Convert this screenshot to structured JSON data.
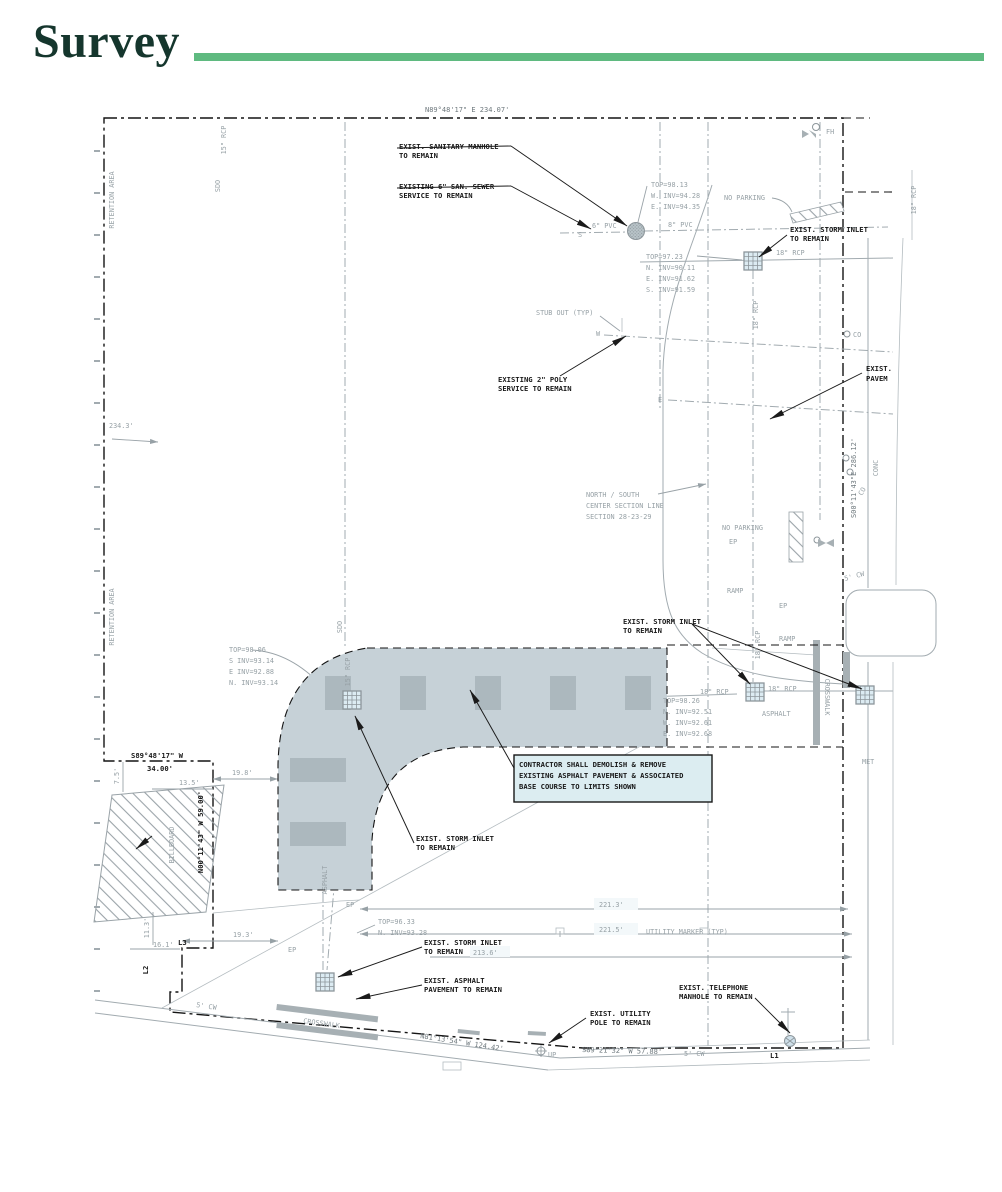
{
  "header": {
    "title": "Survey"
  },
  "colors": {
    "parcel": "#d2e5ef",
    "hatch_base": "#c6d1d7",
    "line_gray": "#9aa3a8",
    "black": "#181818",
    "title_green": "#15362d",
    "rule_green": "#5fba80"
  },
  "boundary": {
    "north": "N89°48'17\" E 234.07'",
    "east": "S00°11'43\"E 286.12'",
    "south_a": "N81°13'54\" W 124.42'",
    "south_b": "S89°21'32\" W 57.88'",
    "notch_bearing": "S89°48'17\" W",
    "notch_length": "34.00'",
    "notch_side": "N00°11'43\" W 59.00'",
    "l1": "L1",
    "l2": "L2",
    "l3": "L3"
  },
  "callouts": {
    "sanitary": {
      "l1": "EXIST. SANITARY MANHOLE",
      "l2": "TO REMAIN"
    },
    "sewer": {
      "l1": "EXISTING 6\" SAN. SEWER",
      "l2": "SERVICE TO REMAIN"
    },
    "storm_ne": {
      "l1": "EXIST. STORM INLET",
      "l2": "TO REMAIN"
    },
    "poly": {
      "l1": "EXISTING 2\" POLY",
      "l2": "SERVICE TO REMAIN"
    },
    "pave_e": {
      "l1": "EXIST.",
      "l2": "PAVEM"
    },
    "storm_mid": {
      "l1": "EXIST. STORM INLET",
      "l2": "TO REMAIN"
    },
    "storm_c": {
      "l1": "EXIST. STORM INLET",
      "l2": "TO REMAIN"
    },
    "storm_s": {
      "l1": "EXIST. STORM INLET",
      "l2": "TO REMAIN"
    },
    "asphalt": {
      "l1": "EXIST. ASPHALT",
      "l2": "PAVEMENT TO REMAIN"
    },
    "phone": {
      "l1": "EXIST. TELEPHONE",
      "l2": "MANHOLE TO REMAIN"
    },
    "pole": {
      "l1": "EXIST. UTILITY",
      "l2": "POLE TO REMAIN"
    },
    "contractor": {
      "l1": "CONTRACTOR SHALL DEMOLISH & REMOVE",
      "l2": "EXISTING ASPHALT PAVEMENT & ASSOCIATED",
      "l3": "BASE COURSE TO LIMITS SHOWN"
    }
  },
  "tables": {
    "t1": {
      "l1": "TOP=98.13",
      "l2": "W. INV=94.28",
      "l3": "E. INV=94.35"
    },
    "t2": {
      "l1": "TOP=97.23",
      "l2": "N. INV=90.11",
      "l3": "E. INV=91.62",
      "l4": "S. INV=91.59"
    },
    "t3": {
      "l1": "TOP=98.06",
      "l2": "S INV=93.14",
      "l3": "E INV=92.88",
      "l4": "N. INV=93.14"
    },
    "t4": {
      "l1": "TOP=98.26",
      "l2": "N. INV=92.51",
      "l3": "W. INV=92.61",
      "l4": "E. INV=92.68"
    },
    "t5": {
      "l1": "TOP=96.33",
      "l2": "N. INV=93.28"
    }
  },
  "pipes": {
    "pvc6": "6\" PVC",
    "pvc8": "8\" PVC",
    "rcp18": "18\" RCP",
    "rcp15": "15\" RCP",
    "sdo": "SDO",
    "stub": "STUB OUT (TYP)",
    "dir_s": "S",
    "dir_w": "W",
    "dir_e": "E"
  },
  "areas": {
    "retention": "RETENTION AREA",
    "billboard": "BILLBOARD",
    "asphalt": "ASPHALT",
    "no_parking": "NO PARKING",
    "ramp": "RAMP",
    "ep": "EP",
    "crosswalk": "CROSSWALK",
    "conc": "CONC",
    "met": "MET",
    "cw5": "5' CW",
    "co": "CO",
    "fh": "FH",
    "up": "UP",
    "ns1": "NORTH / SOUTH",
    "ns2": "CENTER SECTION LINE",
    "ns3": "SECTION 28-23-29",
    "utility_marker": "UTILITY MARKER (TYP)"
  },
  "dims": {
    "d234_3": "234.3'",
    "d7_5": "7.5'",
    "d11_3": "11.3'",
    "d13_5": "13.5'",
    "d16_1": "16.1'",
    "d19_3": "19.3'",
    "d19_8": "19.8'",
    "d221_3": "221.3'",
    "d221_5": "221.5'",
    "d213_6": "213.6'"
  }
}
